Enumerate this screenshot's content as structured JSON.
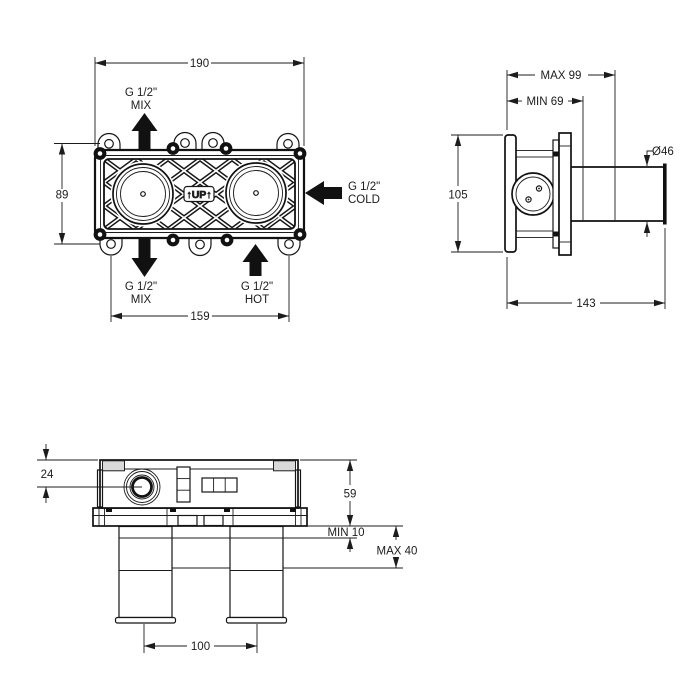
{
  "front_view": {
    "dim_width": "190",
    "dim_height": "89",
    "dim_hole_spacing": "159",
    "up_marking": "↑UP↑",
    "connections": {
      "mix_top": {
        "size": "G 1/2\"",
        "label": "MIX"
      },
      "mix_bottom": {
        "size": "G 1/2\"",
        "label": "MIX"
      },
      "hot": {
        "size": "G 1/2\"",
        "label": "HOT"
      },
      "cold": {
        "size": "G 1/2\"",
        "label": "COLD"
      }
    }
  },
  "side_view": {
    "dim_depth_max": "MAX 99",
    "dim_depth_min": "MIN 69",
    "dim_height": "105",
    "dim_depth_total": "143",
    "dim_sleeve_diameter": "Ø46"
  },
  "bottom_view": {
    "dim_port_offset": "24",
    "dim_body_depth": "59",
    "dim_plaster_min": "MIN 10",
    "dim_plaster_max": "MAX 40",
    "dim_pipe_spacing": "100"
  },
  "colors": {
    "line": "#1c1c1c",
    "background": "#ffffff"
  }
}
